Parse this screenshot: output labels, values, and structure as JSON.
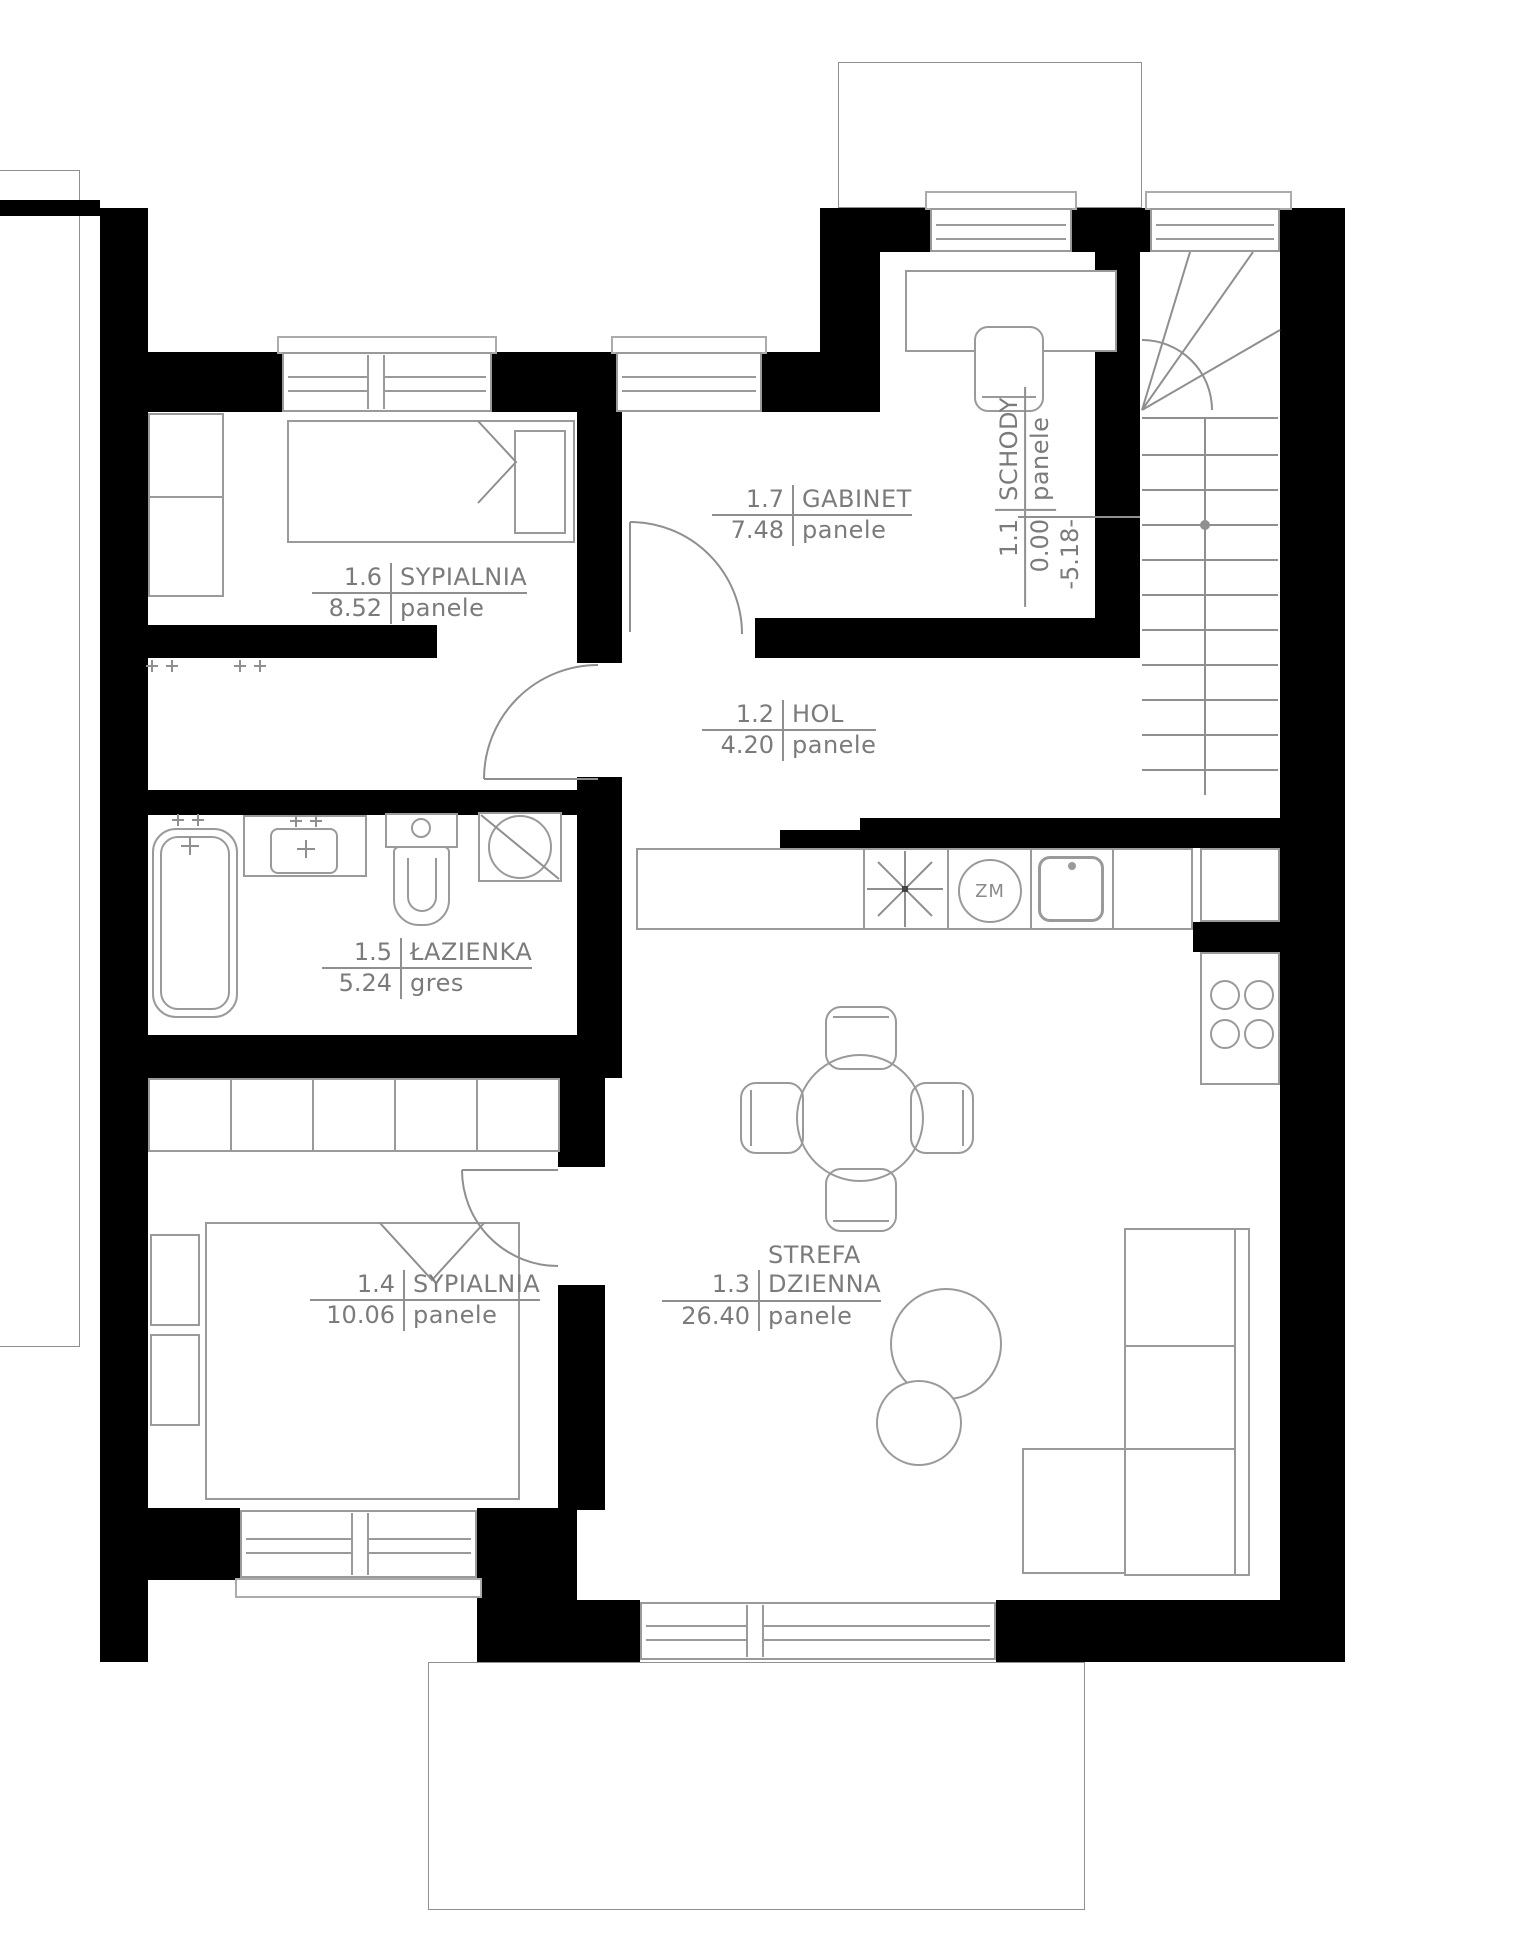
{
  "plan": {
    "type": "architectural-floor-plan",
    "rooms": [
      {
        "number": "1.1",
        "name": "SCHODY",
        "area": "0.00",
        "flooring": "panele",
        "level": "-5.18-"
      },
      {
        "number": "1.2",
        "name": "HOL",
        "area": "4.20",
        "flooring": "panele"
      },
      {
        "number": "1.3",
        "name_line1": "STREFA",
        "name": "DZIENNA",
        "area": "26.40",
        "flooring": "panele"
      },
      {
        "number": "1.4",
        "name": "SYPIALNIA",
        "area": "10.06",
        "flooring": "panele"
      },
      {
        "number": "1.5",
        "name": "ŁAZIENKA",
        "area": "5.24",
        "flooring": "gres"
      },
      {
        "number": "1.6",
        "name": "SYPIALNIA",
        "area": "8.52",
        "flooring": "panele"
      },
      {
        "number": "1.7",
        "name": "GABINET",
        "area": "7.48",
        "flooring": "panele"
      }
    ],
    "kitchen": {
      "dishwasher_label": "ZM"
    },
    "colors": {
      "wall": "#000000",
      "stroke": "#9a9a9a",
      "text": "#7b7b7b"
    }
  }
}
